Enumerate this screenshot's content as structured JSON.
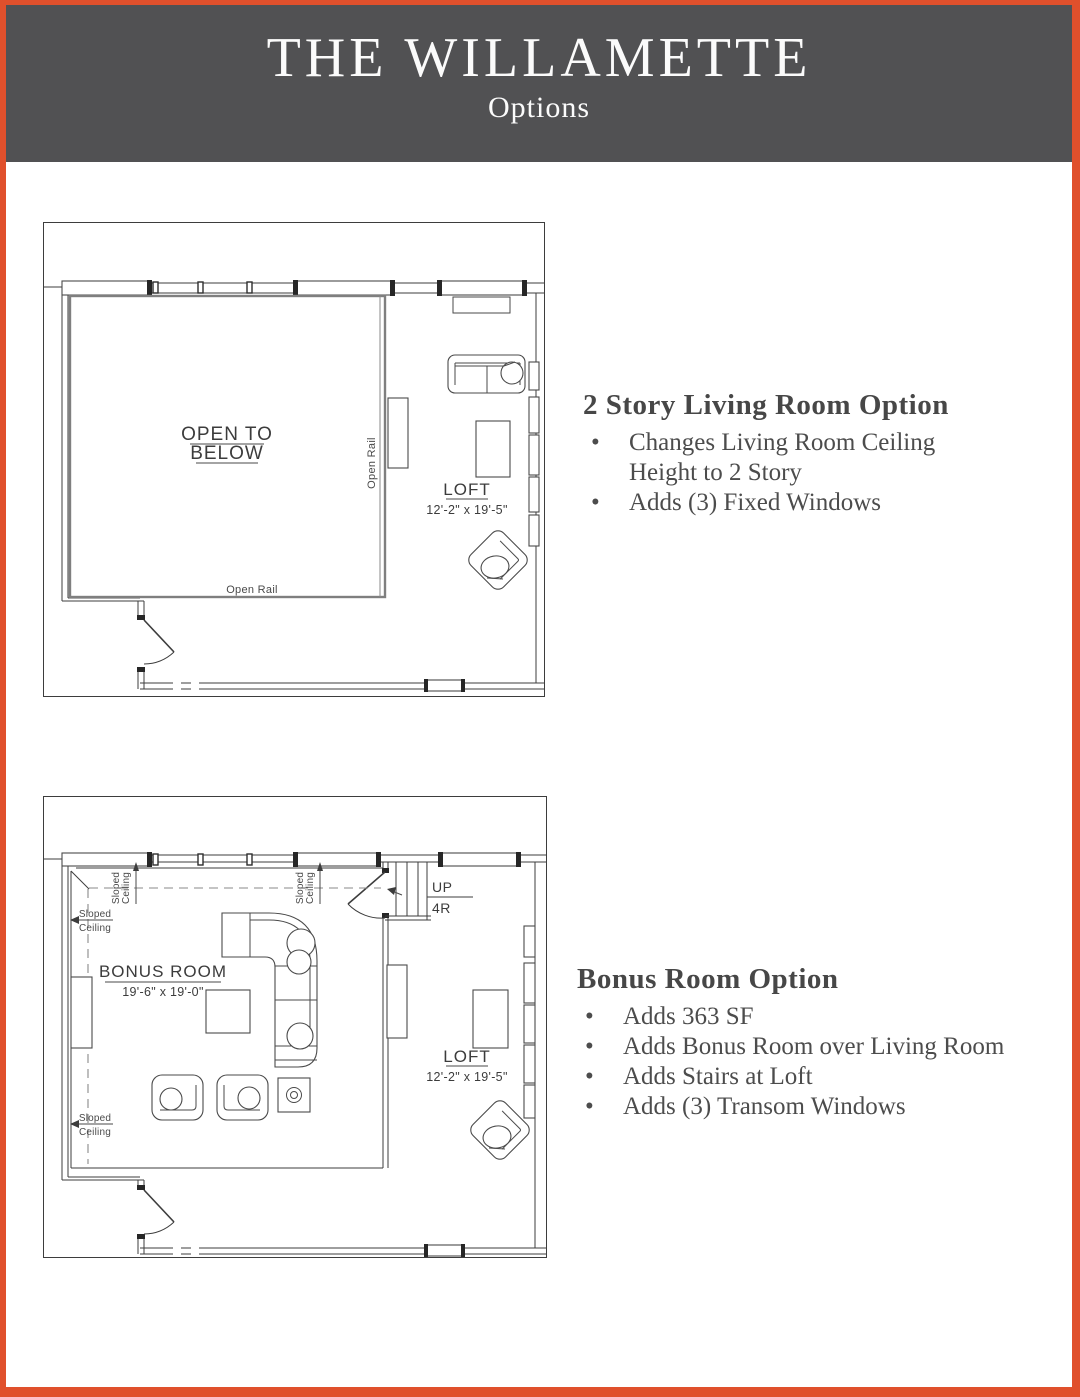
{
  "page": {
    "border_color": "#E0502C",
    "background": "#FFFFFF"
  },
  "header": {
    "title": "THE WILLAMETTE",
    "subtitle": "Options",
    "bg_color": "#515153",
    "text_color": "#FFFFFF"
  },
  "sections": [
    {
      "heading": "2 Story Living Room Option",
      "bullets": [
        "Changes Living Room Ceiling Height to 2 Story",
        "Adds (3) Fixed Windows"
      ]
    },
    {
      "heading": "Bonus Room Option",
      "bullets": [
        "Adds 363 SF",
        "Adds Bonus Room over Living Room",
        "Adds Stairs at Loft",
        "Adds (3) Transom Windows"
      ]
    }
  ],
  "plan_2story": {
    "labels": {
      "open_to_below_line1": "OPEN TO",
      "open_to_below_line2": "BELOW",
      "open_rail_bottom": "Open Rail",
      "open_rail_side": "Open Rail",
      "loft": "LOFT",
      "loft_dims": "12'-2\" x 19'-5\""
    }
  },
  "plan_bonus": {
    "labels": {
      "bonus_room": "BONUS ROOM",
      "bonus_dims": "19'-6\" x 19'-0\"",
      "loft": "LOFT",
      "loft_dims": "12'-2\" x 19'-5\"",
      "up": "UP",
      "risers": "4R",
      "sloped": "Sloped",
      "ceiling": "Ceiling"
    }
  }
}
